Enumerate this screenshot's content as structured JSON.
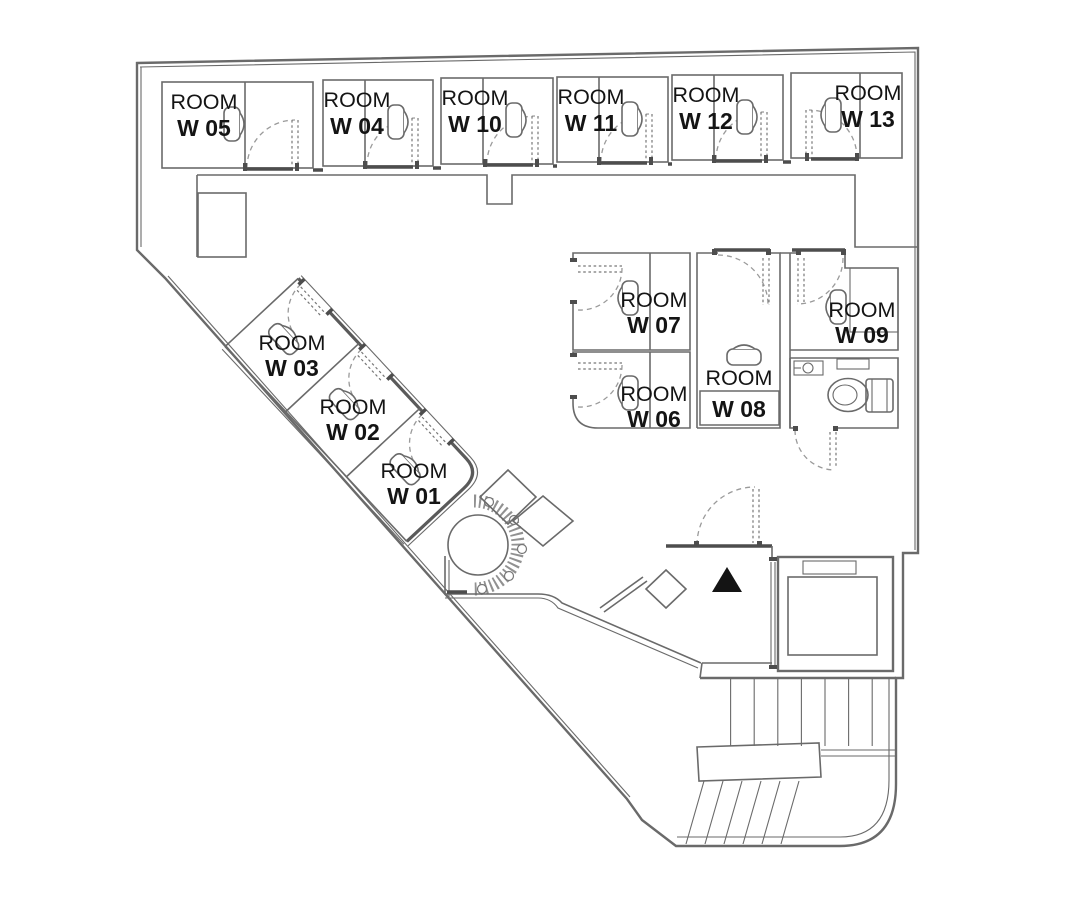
{
  "colors": {
    "background": "#ffffff",
    "wall": "#6a6a6a",
    "wall_dark": "#4d4d4d",
    "door_dash": "#9a9a9a",
    "text": "#141414",
    "marker": "#111111"
  },
  "icons": {
    "sink": "rounded-rect-with-bracket",
    "toilet": "toilet-plan-symbol",
    "washbasin": "rect-with-round-bowl",
    "entrance_marker": "black-triangle-up",
    "planter": "dotted-ring-with-flowers"
  },
  "rooms": [
    {
      "id": "w05",
      "line1": "ROOM",
      "line2": "W 05"
    },
    {
      "id": "w04",
      "line1": "ROOM",
      "line2": "W 04"
    },
    {
      "id": "w10",
      "line1": "ROOM",
      "line2": "W 10"
    },
    {
      "id": "w11",
      "line1": "ROOM",
      "line2": "W 11"
    },
    {
      "id": "w12",
      "line1": "ROOM",
      "line2": "W 12"
    },
    {
      "id": "w13",
      "line1": "ROOM",
      "line2": "W 13"
    },
    {
      "id": "w03",
      "line1": "ROOM",
      "line2": "W 03"
    },
    {
      "id": "w02",
      "line1": "ROOM",
      "line2": "W 02"
    },
    {
      "id": "w01",
      "line1": "ROOM",
      "line2": "W 01"
    },
    {
      "id": "w07",
      "line1": "ROOM",
      "line2": "W 07"
    },
    {
      "id": "w06",
      "line1": "ROOM",
      "line2": "W 06"
    },
    {
      "id": "w08",
      "line1": "ROOM",
      "line2": "W 08"
    },
    {
      "id": "w09",
      "line1": "ROOM",
      "line2": "W 09"
    }
  ]
}
